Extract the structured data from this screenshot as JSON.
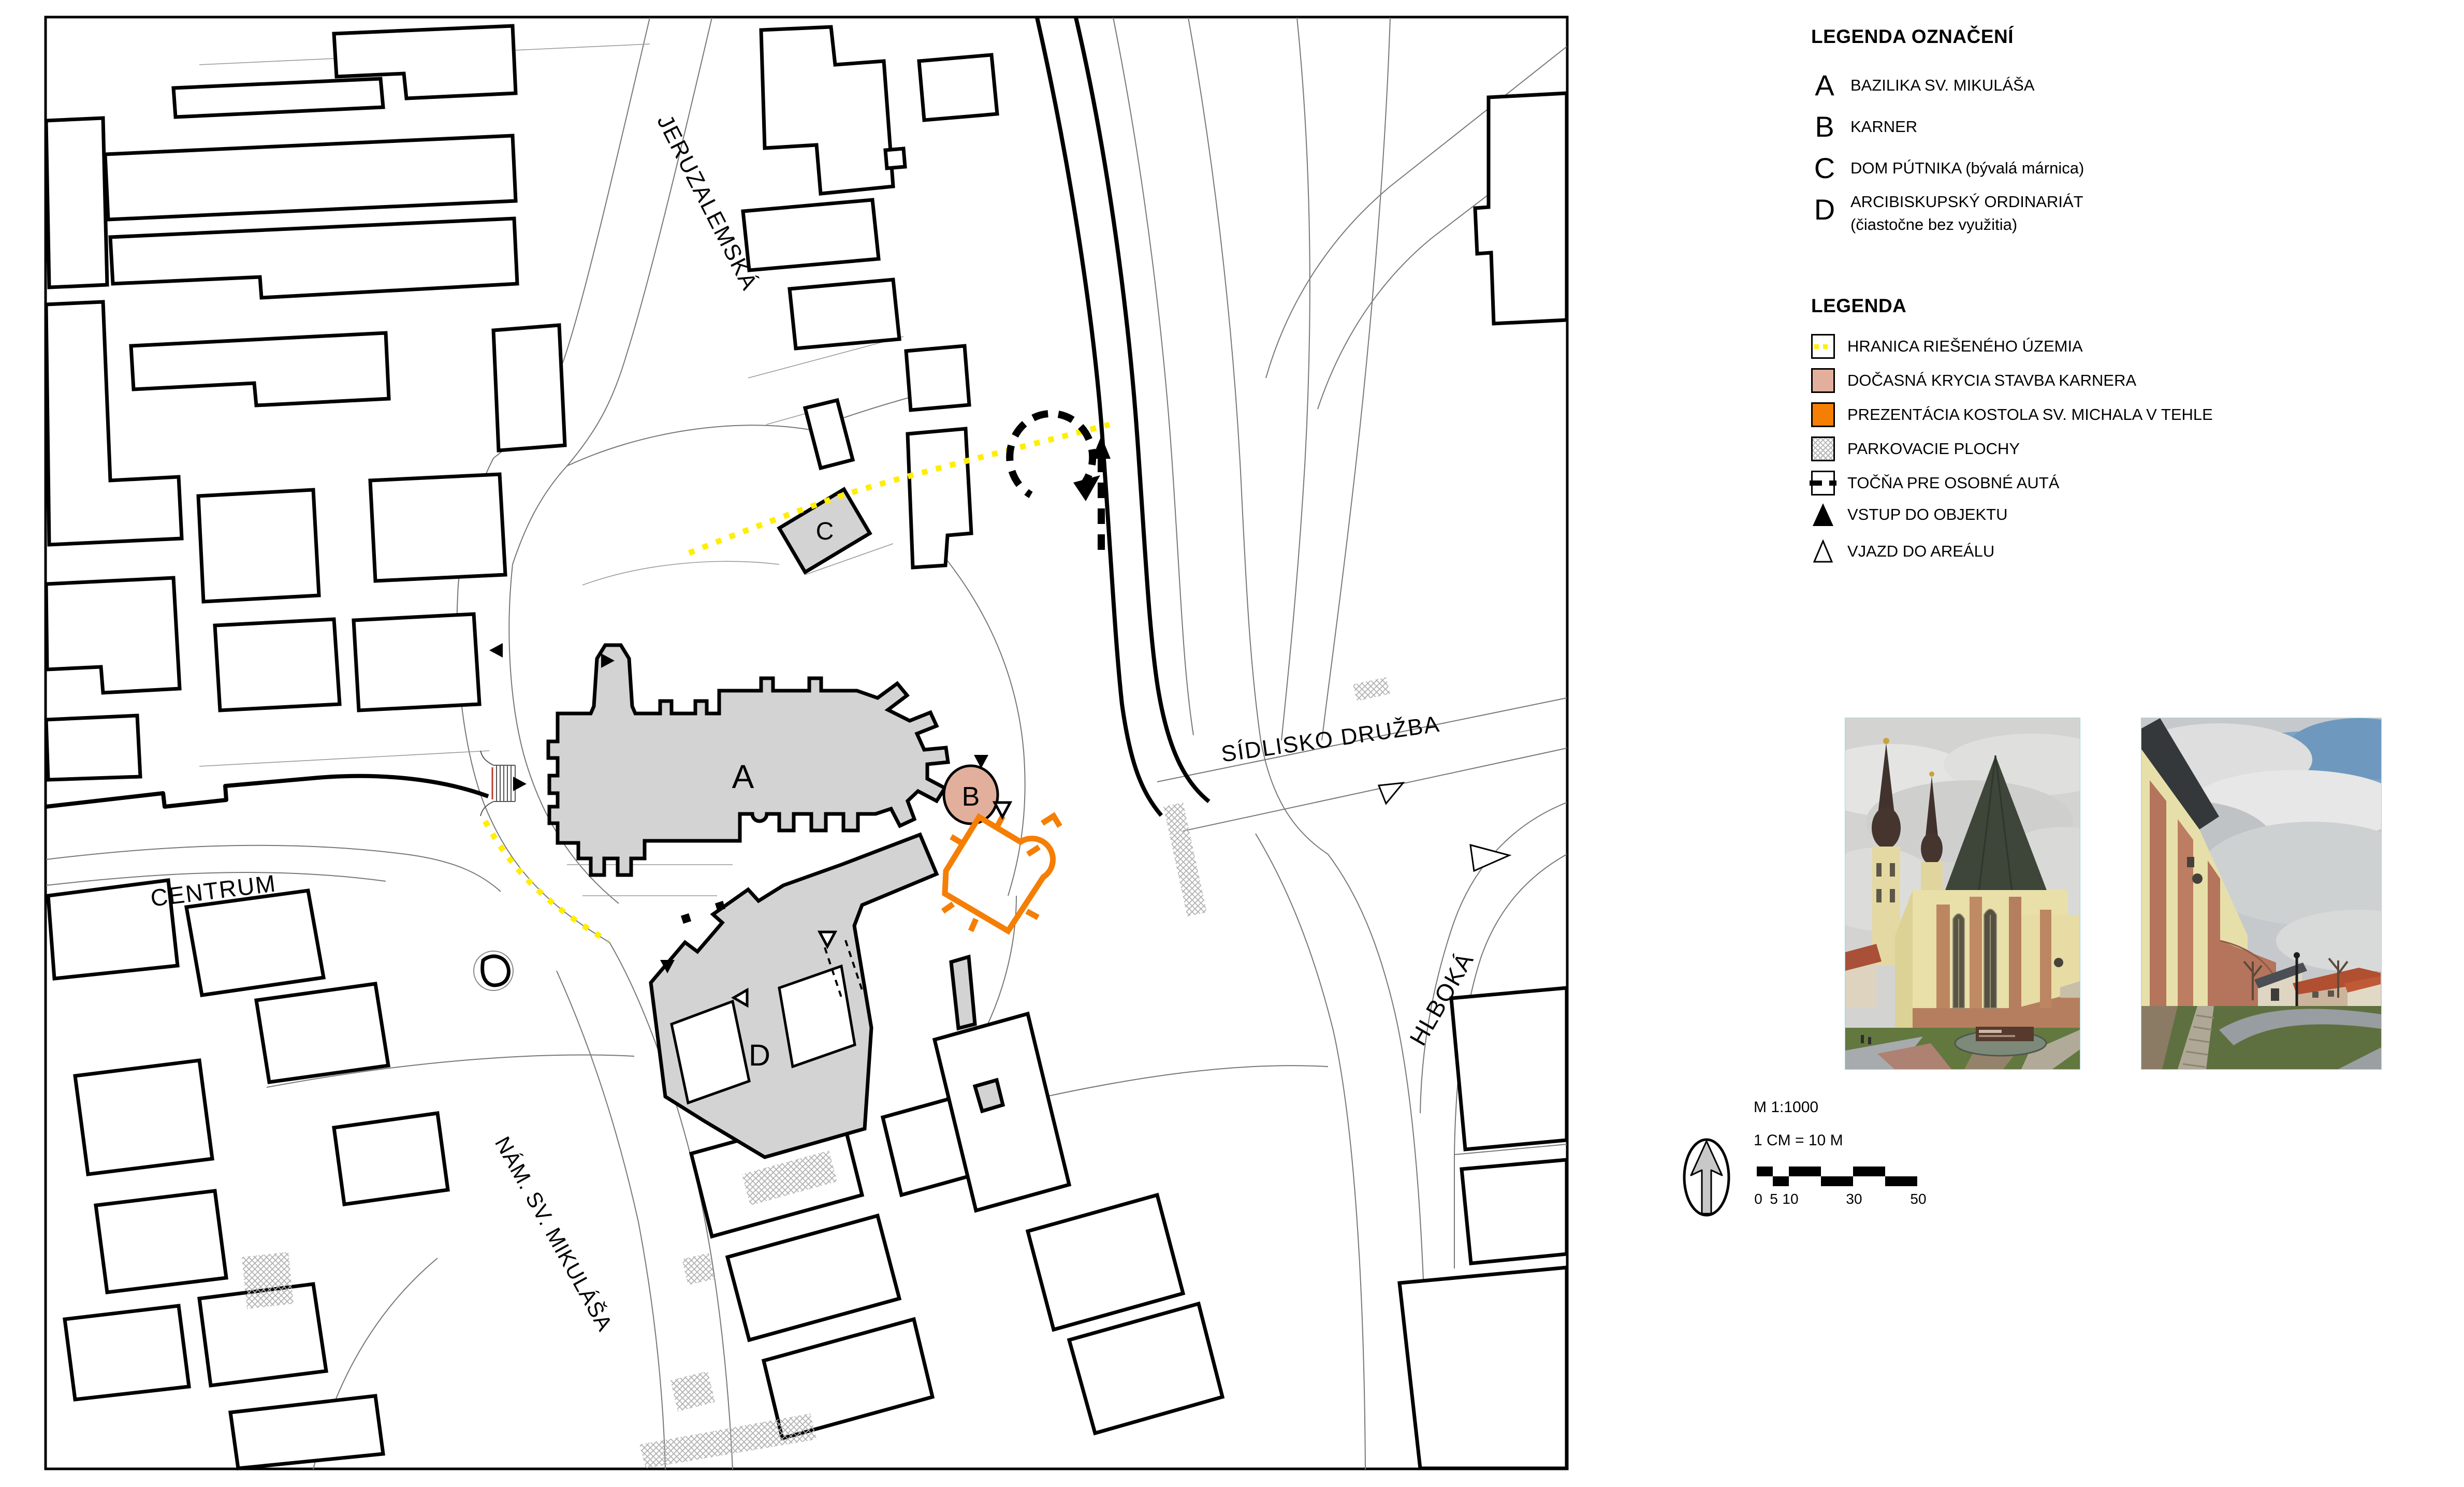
{
  "legend_designations": {
    "title": "LEGENDA OZNAČENÍ",
    "items": [
      {
        "key": "A",
        "label": "BAZILIKA SV. MIKULÁŠA"
      },
      {
        "key": "B",
        "label": "KARNER"
      },
      {
        "key": "C",
        "label": "DOM PÚTNIKA (bývalá márnica)"
      },
      {
        "key": "D",
        "label": "ARCIBISKUPSKÝ ORDINARIÁT",
        "label_line2": "(čiastočne bez využitia)"
      }
    ]
  },
  "legend_symbols": {
    "title": "LEGENDA",
    "items": [
      {
        "id": "boundary",
        "label": "HRANICA RIEŠENÉHO ÚZEMIA"
      },
      {
        "id": "karner-cover",
        "label": "DOČASNÁ KRYCIA STAVBA KARNERA"
      },
      {
        "id": "brick-presentation",
        "label": "PREZENTÁCIA KOSTOLA SV. MICHALA V TEHLE"
      },
      {
        "id": "parking",
        "label": "PARKOVACIE PLOCHY"
      },
      {
        "id": "turning-area",
        "label": "TOČŇA PRE OSOBNÉ AUTÁ"
      },
      {
        "id": "building-entrance",
        "label": "VSTUP DO OBJEKTU"
      },
      {
        "id": "area-entrance",
        "label": "VJAZD DO AREÁLU"
      }
    ]
  },
  "map": {
    "building_labels": {
      "a": "A",
      "b": "B",
      "c": "C",
      "d": "D"
    },
    "streets": {
      "jeruzalemska": "JERUZALEMSKÁ",
      "centrum": "CENTRUM",
      "nam_sv_mikulasa": "NÁM. SV. MIKULÁŠA",
      "sidlisko_druzba": "SÍDLISKO DRUŽBA",
      "hlboka": "HLBOKÁ"
    }
  },
  "scale": {
    "ratio": "M 1:1000",
    "cm_equiv": "1 CM =  10 M",
    "tick_labels": [
      "0",
      "5",
      "10",
      "30",
      "50"
    ]
  },
  "colors": {
    "karner_cover": "#e2af9c",
    "brick_orange": "#f57e04",
    "building_gray": "#d3d3d3",
    "boundary_yellow": "#ffee00"
  }
}
